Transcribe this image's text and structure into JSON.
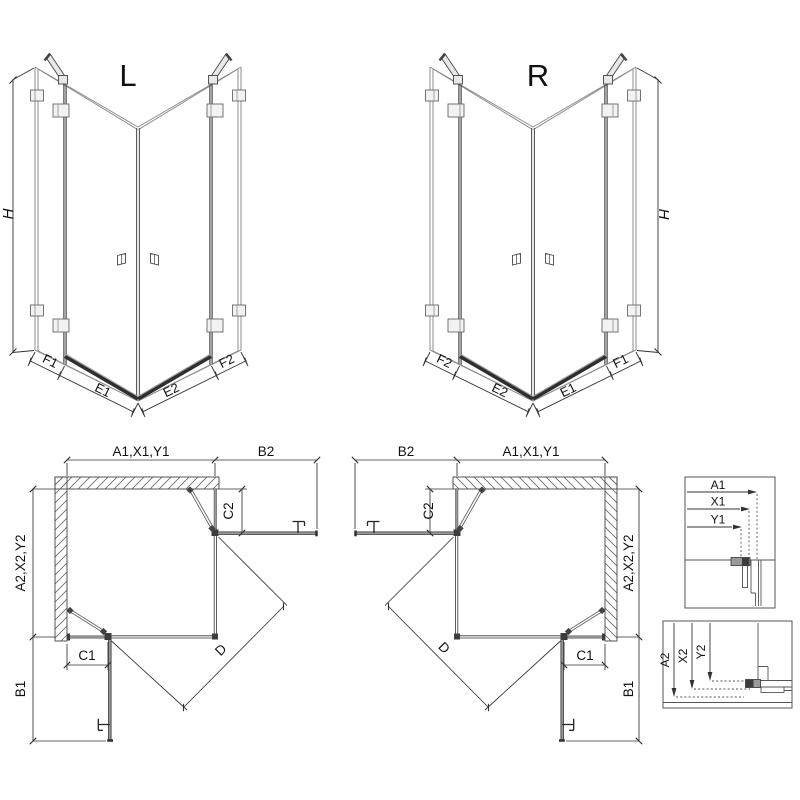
{
  "canvas": {
    "width": 800,
    "height": 800,
    "background": "#ffffff"
  },
  "colors": {
    "glass_edge": "#8c8c8c",
    "profile_dark": "#3d3d3d",
    "panel_gray": "#999999",
    "dimension_line": "#333333",
    "hatch": "#707070",
    "text": "#111111"
  },
  "iso_views": {
    "left": {
      "label": "L",
      "height_dim": "H",
      "bottom_dims": {
        "far_left": "F1",
        "left": "E1",
        "right": "E2",
        "far_right": "F2"
      }
    },
    "right": {
      "label": "R",
      "height_dim": "H",
      "bottom_dims": {
        "far_left": "F2",
        "left": "E2",
        "right": "E1",
        "far_right": "F1"
      }
    }
  },
  "plan_views": {
    "left": {
      "width_dim": "A1,X1,Y1",
      "door_swing_width": "B2",
      "fixed_panel_width": "C2",
      "depth_dim": "A2,X2,Y2",
      "fixed_panel_depth": "C1",
      "door_swing_depth": "B1",
      "diagonal_dim": "D"
    },
    "right": {
      "width_dim": "A1,X1,Y1",
      "door_swing_width": "B2",
      "fixed_panel_width": "C2",
      "depth_dim": "A2,X2,Y2",
      "fixed_panel_depth": "C1",
      "door_swing_depth": "B1",
      "diagonal_dim": "D"
    }
  },
  "detail_views": {
    "width_section": {
      "dims": [
        "A1",
        "X1",
        "Y1"
      ]
    },
    "depth_section": {
      "dims": [
        "A2",
        "X2",
        "Y2"
      ]
    }
  }
}
